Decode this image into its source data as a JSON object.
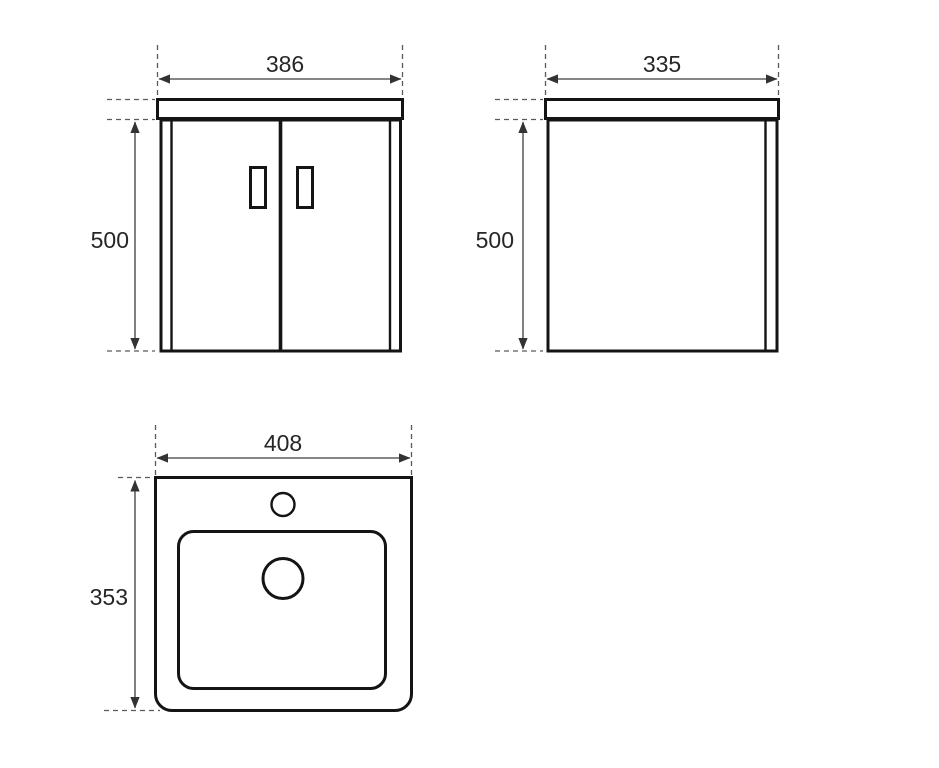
{
  "drawing": {
    "views": {
      "front": {
        "width_label": "386",
        "height_label": "500"
      },
      "side": {
        "width_label": "335",
        "height_label": "500"
      },
      "top": {
        "width_label": "408",
        "depth_label": "353"
      }
    },
    "colors": {
      "object_line": "#141414",
      "dimension_line": "#3d3d3d",
      "extension_line": "#5a5a5a",
      "text": "#262626",
      "background": "#ffffff"
    }
  }
}
